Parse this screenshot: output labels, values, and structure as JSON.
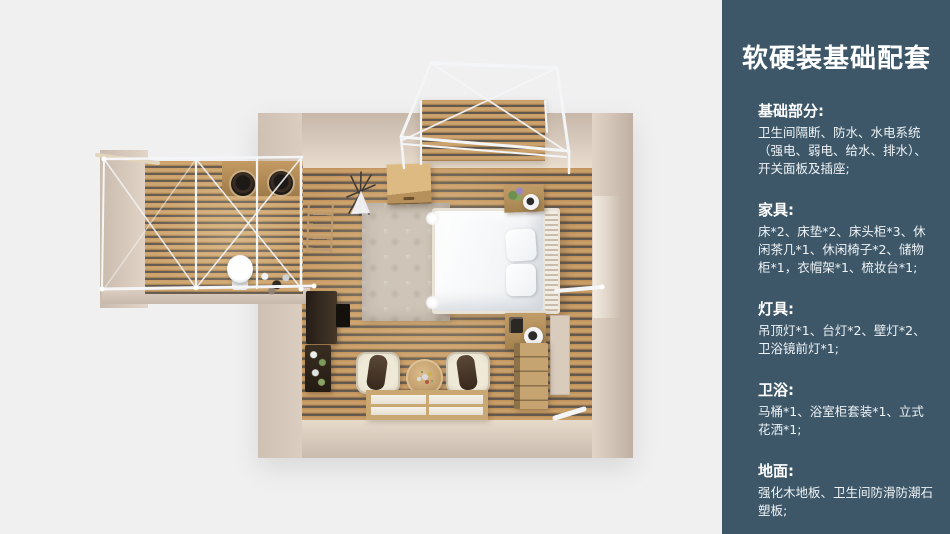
{
  "sidebar": {
    "title": "软硬装基础配套",
    "sections": [
      {
        "heading": "基础部分:",
        "body": "卫生间隔断、防水、水电系统（强电、弱电、给水、排水）、开关面板及插座;"
      },
      {
        "heading": "家具:",
        "body": "床*2、床垫*2、床头柜*3、休闲茶几*1、休闲椅子*2、储物柜*1，衣帽架*1、梳妆台*1;"
      },
      {
        "heading": "灯具:",
        "body": "吊顶灯*1、台灯*2、壁灯*2、卫浴镜前灯*1;"
      },
      {
        "heading": "卫浴:",
        "body": "马桶*1、浴室柜套装*1、立式花洒*1;"
      },
      {
        "heading": "地面:",
        "body": "强化木地板、卫生间防滑防潮石塑板;"
      }
    ]
  },
  "colors": {
    "page_background": "#f0f0f1",
    "sidebar_background": "#3d5768",
    "sidebar_text": "#ffffff",
    "wall_beige": "#d2c4b7",
    "wood_floor_light": "#c49a63",
    "wood_floor_gap": "#59514a",
    "rug": "#cec5b8",
    "bed_linen": "#f7f8fa",
    "structure_frame_white": "#f4f5f7",
    "furniture_wood": "#c3a06c",
    "dark_furniture": "#352b21"
  },
  "floorplan": {
    "items": [
      "balcony-deck",
      "roof-wireframe",
      "bathroom-pod",
      "vanity-two-basins",
      "toilet",
      "standing-shower",
      "double-bed",
      "pillows",
      "headboard",
      "bedside-table-top",
      "bedside-table-bottom",
      "table-lamp-top",
      "table-lamp-bottom",
      "area-rug",
      "wardrobe-cabinet",
      "drawer-chest",
      "lounge-chair-left",
      "lounge-chair-right",
      "tea-table",
      "tatami-mat",
      "dressing-table",
      "plant-rack",
      "ladder-rack",
      "teepee-ornament",
      "towel-rail",
      "mirror-panel"
    ]
  }
}
